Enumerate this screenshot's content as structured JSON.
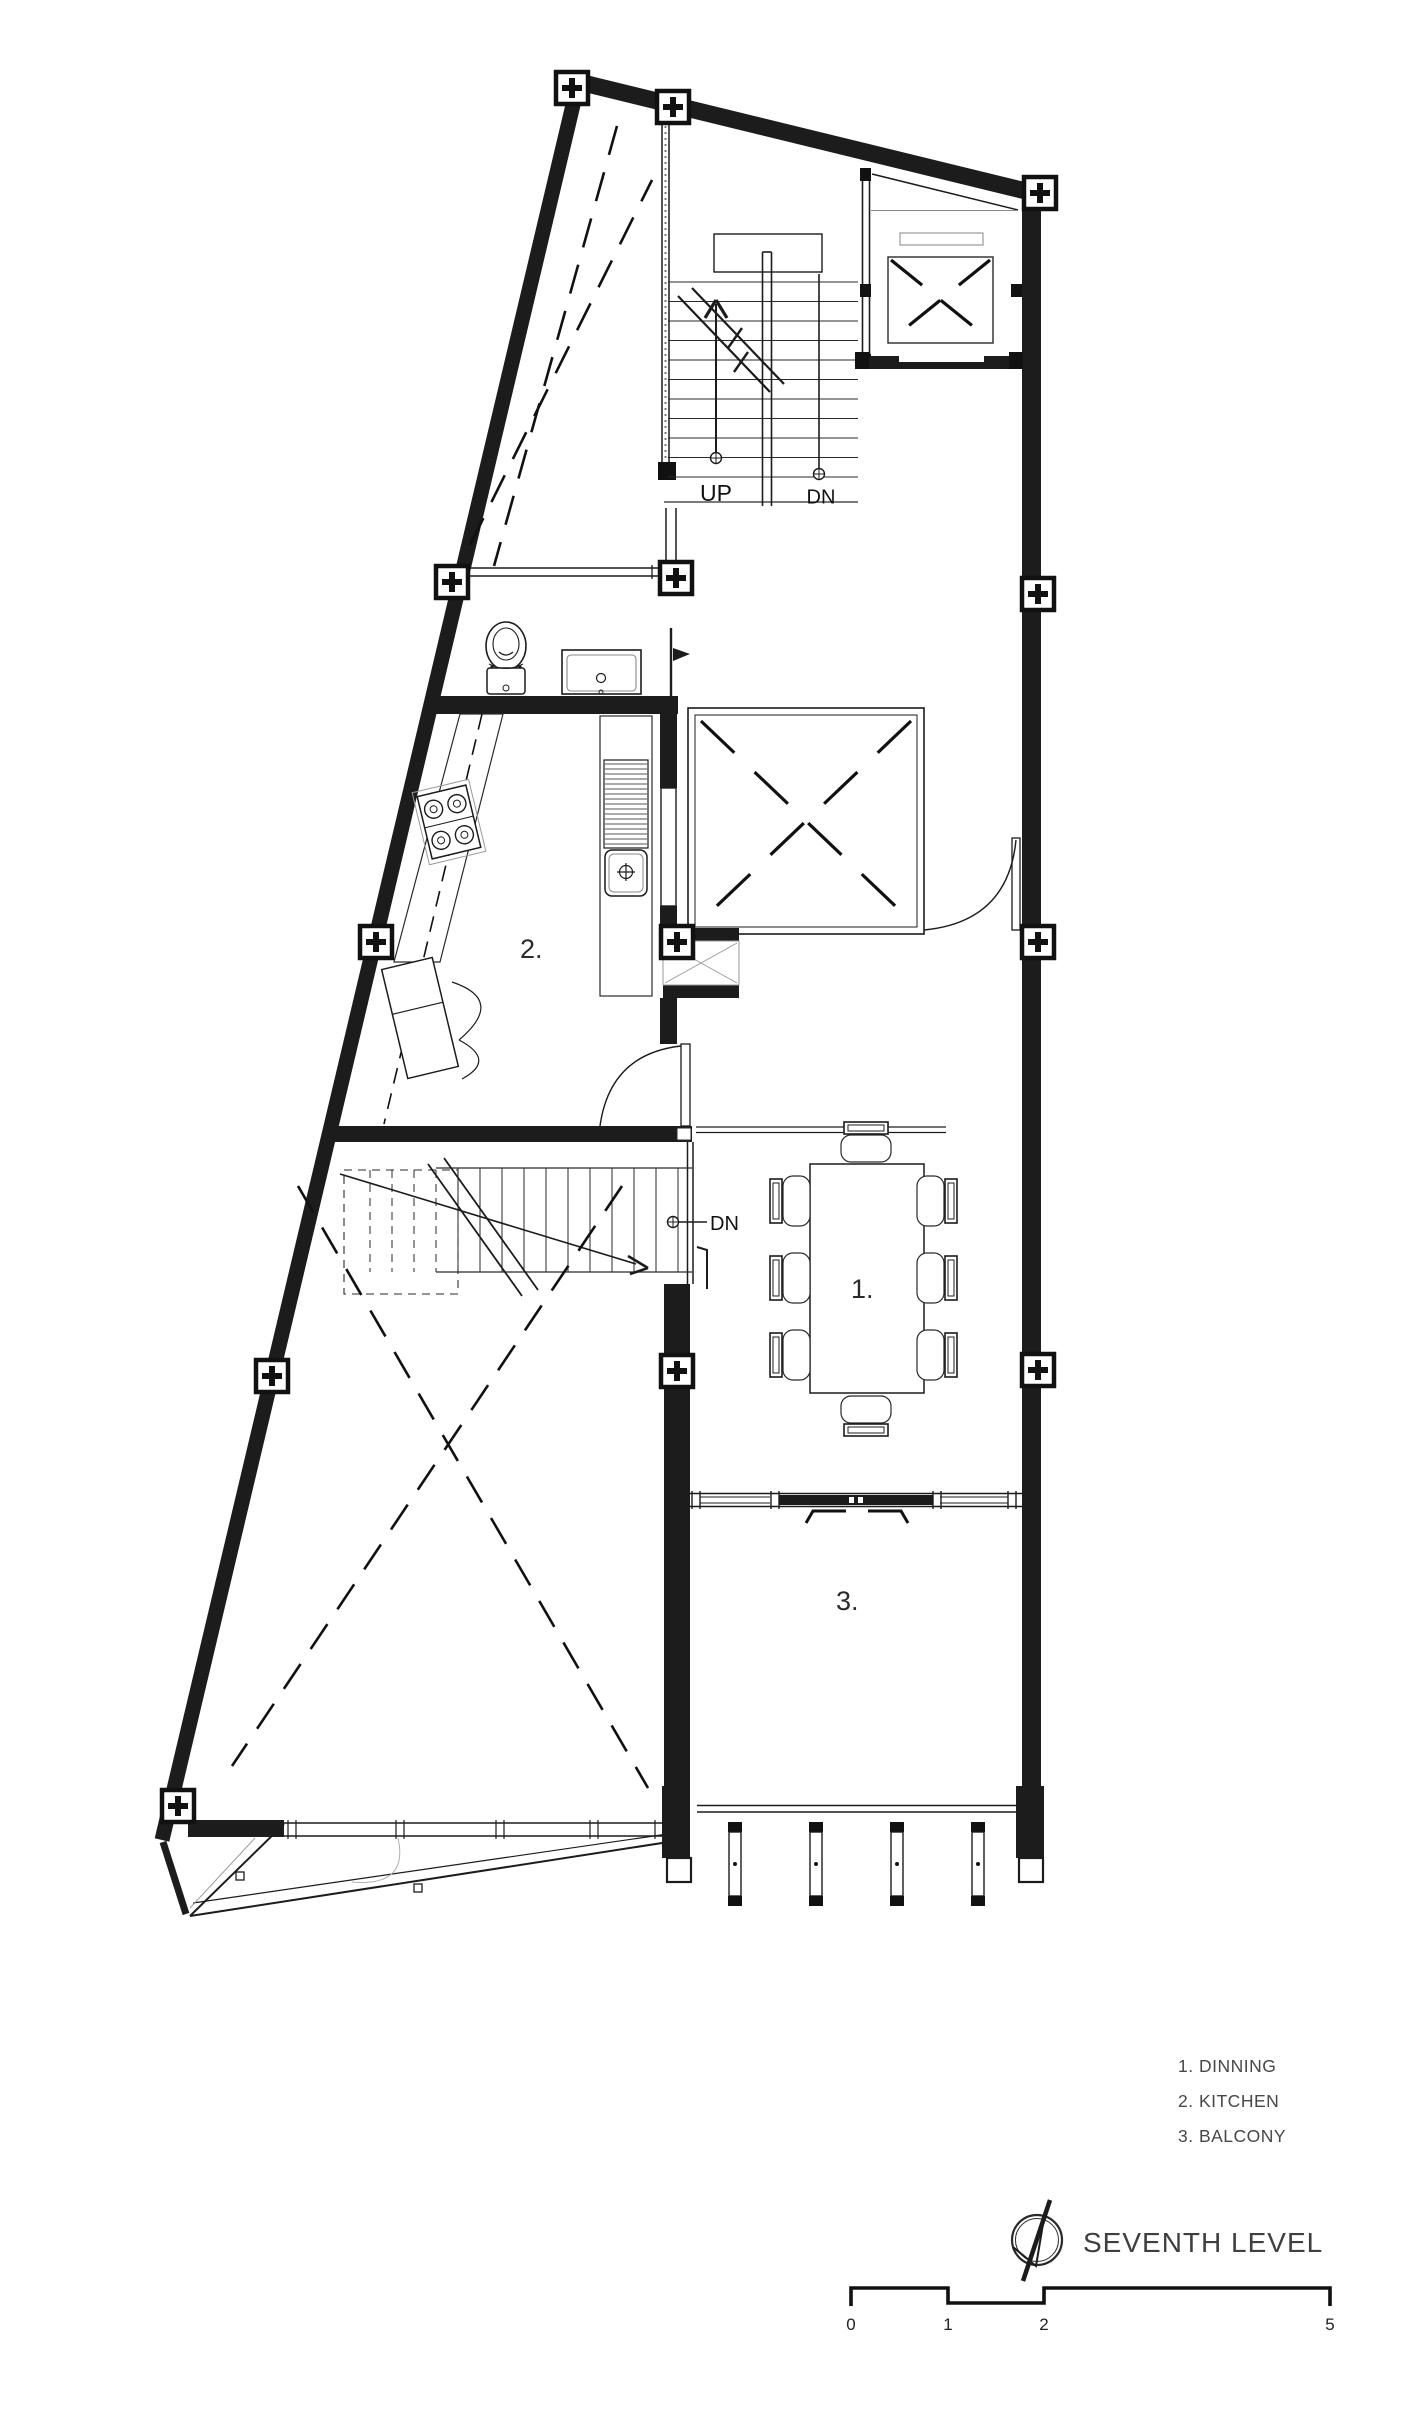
{
  "drawing": {
    "title": "SEVENTH LEVEL",
    "room_labels": {
      "dining": "1.",
      "kitchen": "2.",
      "balcony": "3."
    },
    "stair_annotations": {
      "up": "UP",
      "down_top": "DN",
      "down_main": "DN"
    },
    "legend": {
      "items": [
        {
          "number": "1.",
          "name": "DINNING",
          "text": "1. DINNING"
        },
        {
          "number": "2.",
          "name": "KITCHEN",
          "text": "2. KITCHEN"
        },
        {
          "number": "3.",
          "name": "BALCONY",
          "text": "3. BALCONY"
        }
      ]
    },
    "scale_bar": {
      "labels": [
        "0",
        "1",
        "2",
        "5"
      ]
    },
    "icons": {
      "north": "north-arrow-icon",
      "grid_marker": "grid-column-marker"
    },
    "colors": {
      "ink": "#1c1c1c",
      "text_gray": "#474747",
      "light_gray": "#9a9a9a"
    }
  }
}
